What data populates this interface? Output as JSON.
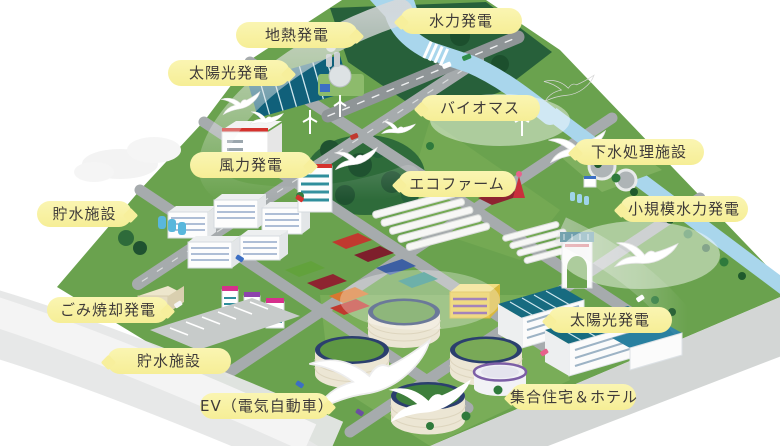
{
  "canvas": {
    "width": 780,
    "height": 446,
    "background": "#ffffff"
  },
  "labels": [
    {
      "id": "hydro-power",
      "text": "水力発電"
    },
    {
      "id": "geothermal-power",
      "text": "地熱発電"
    },
    {
      "id": "solar-power-top",
      "text": "太陽光発電"
    },
    {
      "id": "biomass",
      "text": "バイオマス"
    },
    {
      "id": "sewage-treatment",
      "text": "下水処理施設"
    },
    {
      "id": "wind-power",
      "text": "風力発電"
    },
    {
      "id": "eco-farm",
      "text": "エコファーム"
    },
    {
      "id": "water-storage-top",
      "text": "貯水施設"
    },
    {
      "id": "small-hydro-power",
      "text": "小規模水力発電"
    },
    {
      "id": "waste-incineration",
      "text": "ごみ焼却発電"
    },
    {
      "id": "solar-power-right",
      "text": "太陽光発電"
    },
    {
      "id": "water-storage-bottom",
      "text": "貯水施設"
    },
    {
      "id": "ev-car",
      "text": "EV（電気自動車）"
    },
    {
      "id": "housing-hotel",
      "text": "集合住宅＆ホテル"
    }
  ],
  "palette": {
    "label_bg": "#F7EF9C",
    "label_text": "#3E3A39",
    "land_green": "#6AA24E",
    "forest_green": "#27603A",
    "water_blue": "#A9D6EC",
    "road_gray": "#A6ABAD",
    "solar_teal": "#10607A",
    "tank_cream": "#ECE6D4",
    "tank_ring_navy": "#2B3F6E",
    "tank_top_green": "#5E9743",
    "accent_red": "#D5322D",
    "swoosh_gray": "#DFE0E1"
  },
  "icons": {
    "bird": "seagull-silhouette",
    "cloud": "soft-cloud",
    "wind_turbine": "three-blade-turbine"
  }
}
